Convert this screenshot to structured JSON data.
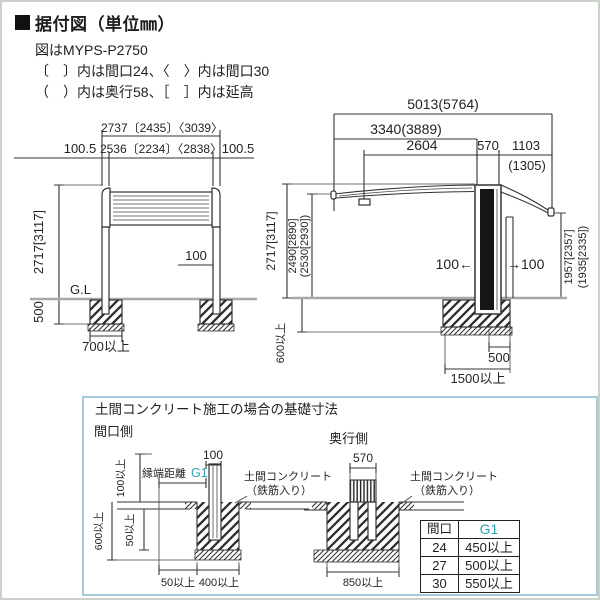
{
  "header": {
    "title": "据付図（単位㎜）",
    "subtitle": "図はMYPS-P2750",
    "note1": "〔　〕内は間口24、〈　〉内は間口30",
    "note2": "（　）内は奥行58、［　］内は延高"
  },
  "front_view": {
    "dim_width_outer": "2737〔2435〕〈3039〉",
    "dim_width_inner": "2536〔2234〕〈2838〉",
    "dim_overhang_left": "100.5",
    "dim_overhang_right": "100.5",
    "dim_height": "2717[3117]",
    "dim_embed_depth": "500",
    "ground_label": "G.L",
    "dim_post_inset": "100",
    "dim_footing_width": "700以上"
  },
  "side_view": {
    "dim_total_depth": "5013(5764)",
    "dim_front_section": "3340(3889)",
    "dim_front_arm": "2604",
    "dim_post_depth": "570",
    "dim_rear_overhang": "1103",
    "dim_rear_overhang_alt": "(1305)",
    "dim_height": "2717[3117]",
    "dim_front_clearance": "2490[2890]",
    "dim_front_clearance_alt": "(2530[2930])",
    "dim_embed_depth": "600以上",
    "dim_post_shift_left": "100←",
    "dim_post_shift_right": "→100",
    "dim_rear_clearance": "1957[2357]",
    "dim_rear_clearance_alt": "(1935[2335])",
    "dim_footing_500": "500",
    "dim_footing_width": "1500以上"
  },
  "foundation_box": {
    "title": "土間コンクリート施工の場合の基礎寸法",
    "left_section_label": "間口側",
    "right_section_label": "奥行側",
    "left": {
      "dim_100": "100",
      "edge_distance_label": "縁端距離",
      "edge_distance_value": "G1",
      "concrete_label_1": "土間コンクリート",
      "concrete_label_2": "（鉄筋入り）",
      "dim_100_min": "100以上",
      "dim_600_min": "600以上",
      "dim_50_min_side": "50以上",
      "dim_50_min_bottom": "50以上",
      "dim_400_min": "400以上"
    },
    "right": {
      "dim_570": "570",
      "concrete_label_1": "土間コンクリート",
      "concrete_label_2": "（鉄筋入り）",
      "dim_850_min": "850以上"
    },
    "table": {
      "headers": [
        "間口",
        "G1"
      ],
      "rows": [
        [
          "24",
          "450以上"
        ],
        [
          "27",
          "500以上"
        ],
        [
          "30",
          "550以上"
        ]
      ]
    }
  },
  "colors": {
    "accent_teal": "#2f9fb5",
    "box_border": "#a5c9da",
    "line": "#333333",
    "ground_line": "#a8a8a8"
  }
}
